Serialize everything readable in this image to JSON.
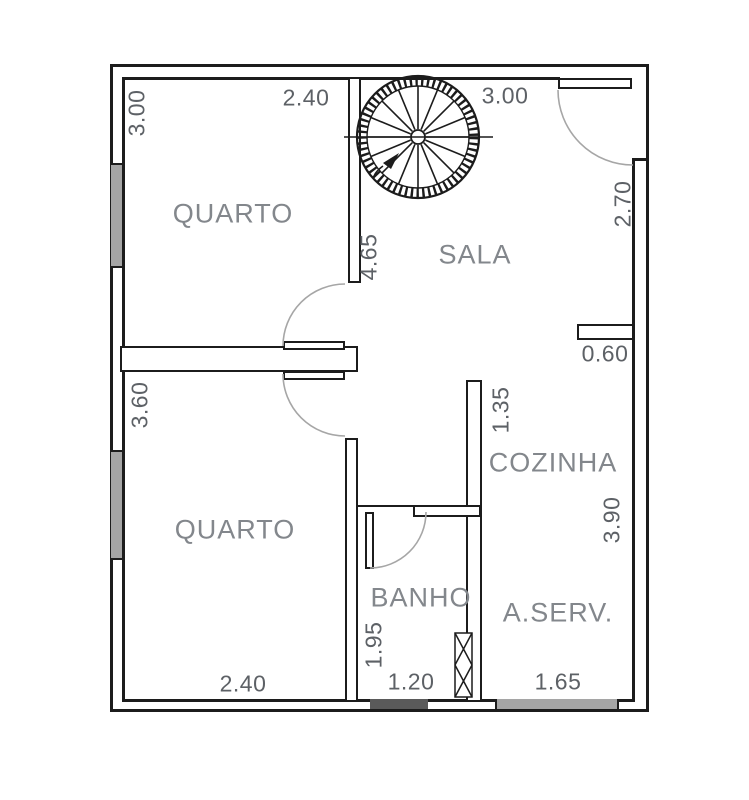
{
  "drawing": {
    "title": "apartment floor plan",
    "rooms": {
      "quarto1": "QUARTO",
      "sala": "SALA",
      "quarto2": "QUARTO",
      "cozinha": "COZINHA",
      "banho": "BANHO",
      "aserv": "A.SERV."
    },
    "dims": {
      "quarto1_w": "2.40",
      "quarto1_h": "3.00",
      "sala_w": "3.00",
      "sala_right": "2.70",
      "sala_depth": "4.65",
      "cozinha_jog": "0.60",
      "cozinha_pass": "1.35",
      "cozinha_h": "3.90",
      "quarto2_h": "3.60",
      "quarto2_w": "2.40",
      "banho_h": "1.95",
      "banho_w": "1.20",
      "aserv_w": "1.65"
    },
    "features": {
      "staircase": "spiral-staircase",
      "doors": [
        "entrance-door",
        "quarto1-door",
        "quarto2-door",
        "banho-door"
      ],
      "windows": [
        "quarto1-window",
        "quarto2-window",
        "aserv-window",
        "banho-vent"
      ]
    },
    "colors": {
      "wall": "#1c1c1c",
      "dim_text": "#5d6166",
      "room_text": "#83878c",
      "arc": "#a6a6a6",
      "window_fill": "#a5a5a5",
      "sill_fill": "#5a5a5a"
    }
  }
}
